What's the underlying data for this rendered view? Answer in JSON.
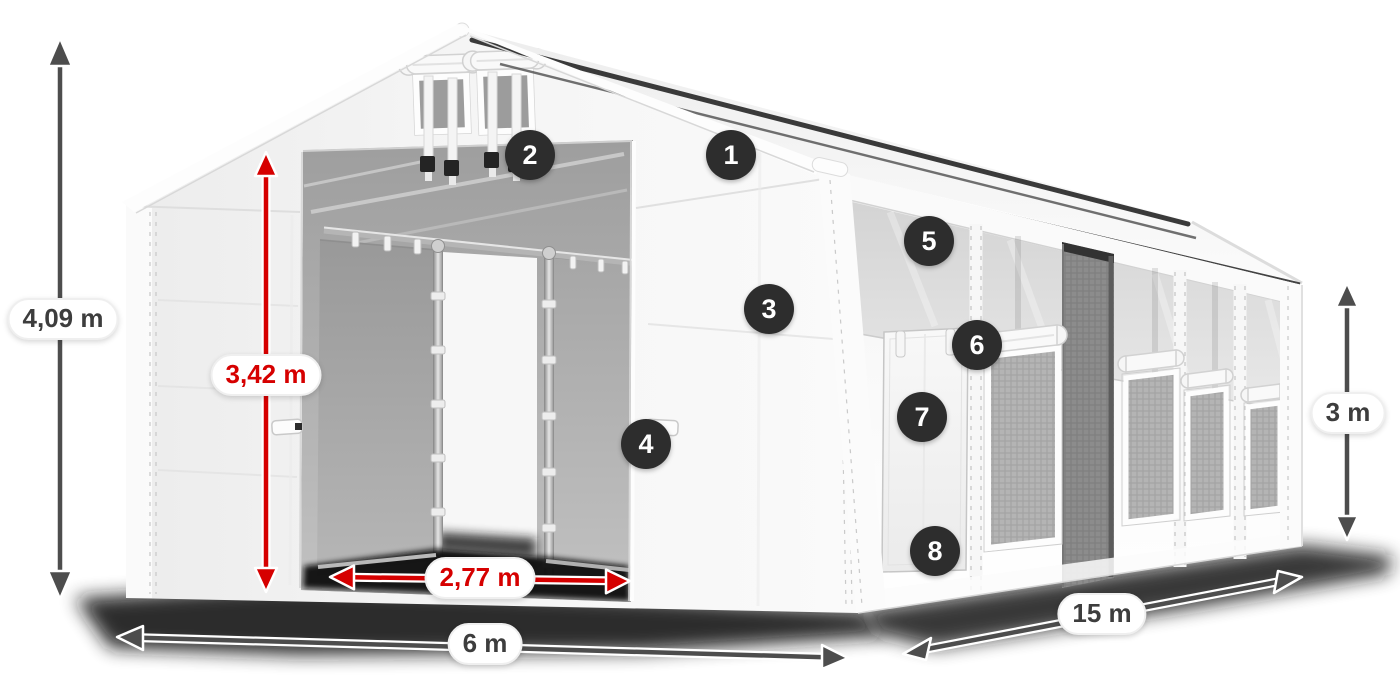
{
  "diagram": {
    "callouts": [
      "1",
      "2",
      "3",
      "4",
      "5",
      "6",
      "7",
      "8"
    ],
    "dimensions": {
      "total_height": "4,09 m",
      "door_height": "3,42 m",
      "door_width": "2,77 m",
      "width": "6 m",
      "length": "15 m",
      "wall_height": "3 m"
    },
    "colors": {
      "dimension_primary": "#4d4d4d",
      "dimension_accent": "#d60000",
      "badge_background": "#2d2d2d",
      "badge_text": "#ffffff"
    }
  }
}
